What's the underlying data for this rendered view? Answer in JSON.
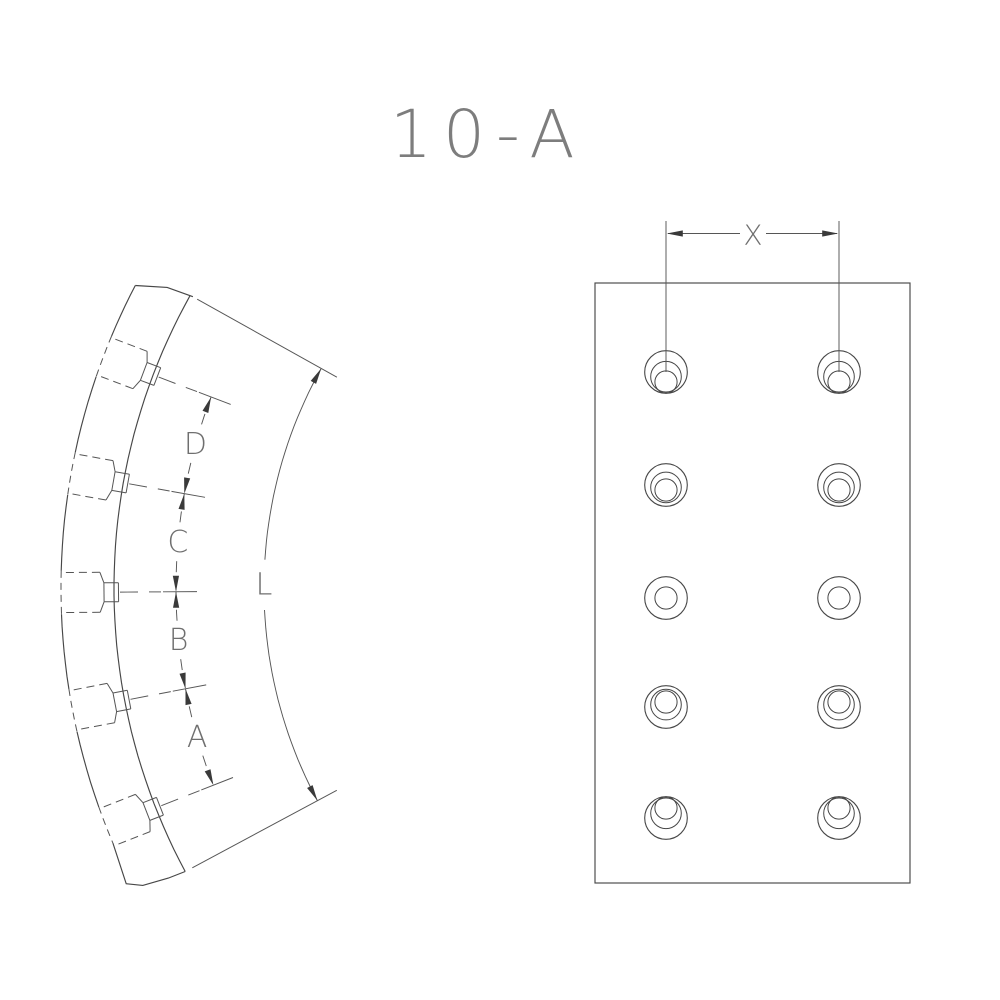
{
  "title": "10-A",
  "side_view": {
    "description": "curved brake lining profile with 5 counterbored rivet holes",
    "segment_labels": [
      "D",
      "C",
      "B",
      "A"
    ],
    "arc_length_label": "L",
    "rivet_count": 5
  },
  "front_view": {
    "description": "flat face view with rivet hole pattern",
    "pitch_label": "X",
    "hole_rows": 5,
    "hole_cols": 2
  },
  "colors": {
    "background": "#ffffff",
    "part_line": "#474747",
    "hidden_line": "#555555",
    "dim_line": "#565656",
    "arrow_fill": "#3a3a3a",
    "text": "#6f6f6f",
    "title_text": "#7d7d7d"
  }
}
